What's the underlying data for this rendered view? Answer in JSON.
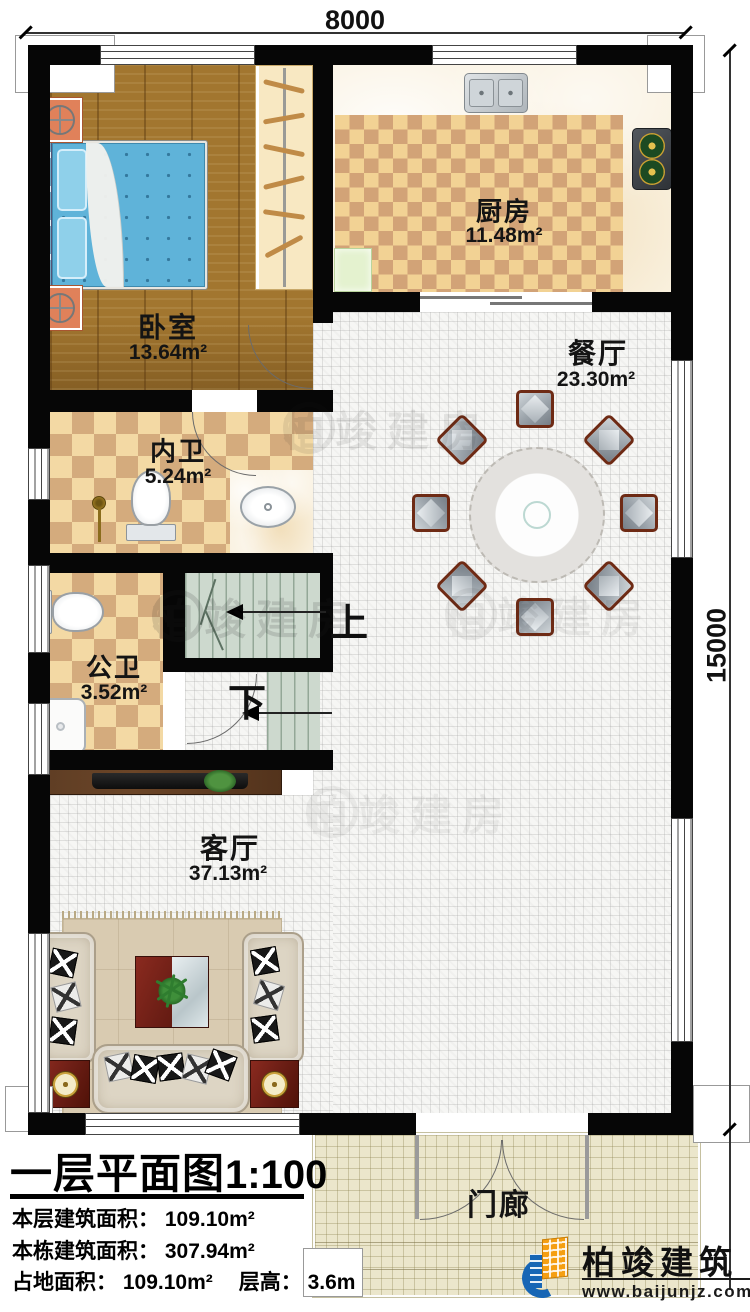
{
  "dimensions": {
    "width_label": "8000",
    "height_label": "15000"
  },
  "rooms": {
    "bedroom": {
      "name": "卧室",
      "area": "13.64m²"
    },
    "kitchen": {
      "name": "厨房",
      "area": "11.48m²"
    },
    "inner_bath": {
      "name": "内卫",
      "area": "5.24m²"
    },
    "dining": {
      "name": "餐厅",
      "area": "23.30m²"
    },
    "public_bath": {
      "name": "公卫",
      "area": "3.52m²"
    },
    "living": {
      "name": "客厅",
      "area": "37.13m²"
    },
    "porch": {
      "name": "门廊"
    }
  },
  "stairs": {
    "up_label": "上",
    "down_label": "下"
  },
  "title_block": {
    "title": "一层平面图",
    "scale": "1:100",
    "floor_area_line": "本层建筑面积： 109.10m²",
    "building_area_line": "本栋建筑面积： 307.94m²",
    "land_area_line": "占地面积： 109.10m²",
    "floor_height_line": "层高： 3.6m"
  },
  "brand": {
    "name": "柏竣建筑",
    "website": "www.baijunjz.com"
  },
  "watermark": {
    "text": "柏竣建房"
  },
  "colors": {
    "accent_blue": "#1766b5",
    "accent_orange": "#f59f13",
    "wall": "#060606"
  }
}
